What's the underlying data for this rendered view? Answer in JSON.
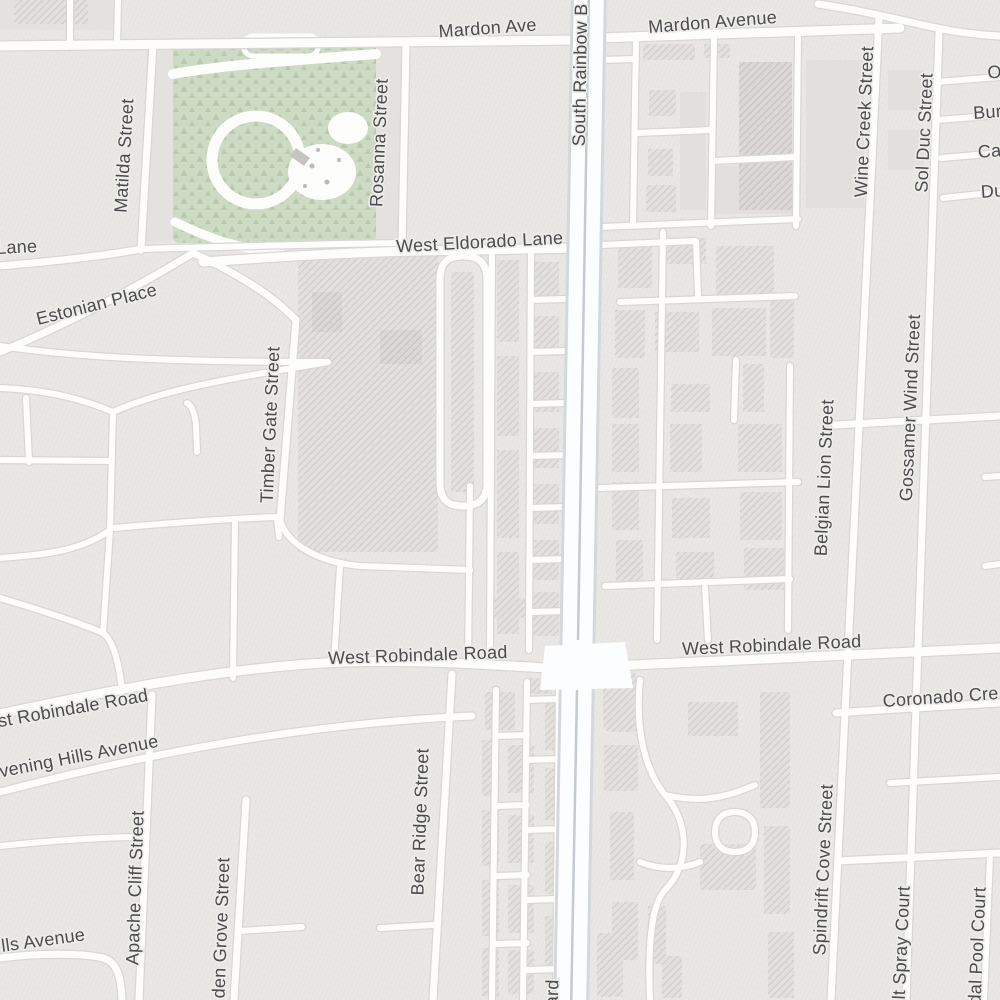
{
  "map": {
    "type": "street-map",
    "labels": {
      "lane_partial": "Lane",
      "mardon_ave": "Mardon Ave",
      "mardon_avenue": "Mardon Avenue",
      "south_rainbow_blvd_top": "South Rainbow B",
      "south_rainbow_blvd_bottom": "ard",
      "matilda_street": "Matilda Street",
      "rosanna_street": "Rosanna Street",
      "west_eldorado_lane": "West Eldorado Lane",
      "estonian_place": "Estonian Place",
      "timber_gate_street": "Timber Gate Street",
      "wine_creek_street": "Wine Creek Street",
      "sol_duc_street": "Sol Duc Street",
      "right_edge_o": "O",
      "right_edge_bur": "Bur",
      "right_edge_ca": "Ca",
      "right_edge_du": "Du",
      "belgian_lion_street": "Belgian Lion Street",
      "gossamer_wind_street": "Gossamer Wind Street",
      "west_robindale_road_center": "West Robindale Road",
      "west_robindale_road_right": "West Robindale Road",
      "west_robindale_road_left": "st Robindale Road",
      "evening_hills_avenue": "vening Hills Avenue",
      "hills_avenue_partial": "lls Avenue",
      "apache_cliff_street": "Apache Cliff Street",
      "garden_grove_street_partial": "den Grove Street",
      "bear_ridge_street": "Bear Ridge Street",
      "coronado_creek_partial": "Coronado Cre",
      "spindrift_cove_street": "Spindrift Cove Street",
      "salt_spray_court_partial": "alt Spray Court",
      "tidal_pool_court_partial": "idal Pool Court"
    },
    "colors": {
      "land": "#eae8e5",
      "road_fill": "#fdfdfc",
      "road_casing": "#d9d6d3",
      "boulevard_fill": "#fcfdfe",
      "boulevard_casing": "#d3d8dc",
      "boulevard_median": "#c3cad1",
      "building_fill": "#e2e0dd",
      "building_hatch": "#c9c6c3",
      "park_fill": "#cedbc4",
      "park_trees": "#b7cbac",
      "label_text": "#4b4c4e",
      "label_halo": "#eeedea"
    }
  }
}
